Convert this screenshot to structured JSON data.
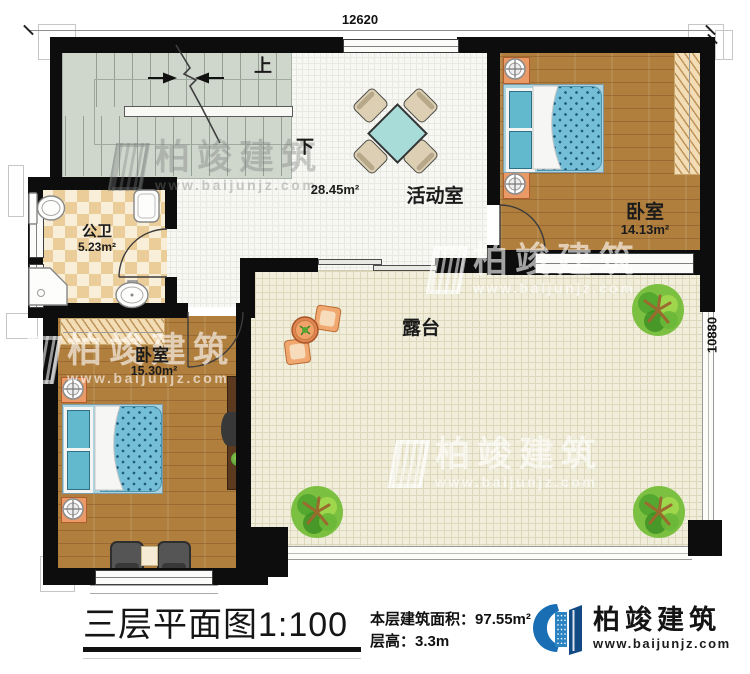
{
  "plan": {
    "dimensions": {
      "top": "12620",
      "right": "10880"
    },
    "stairs": {
      "up": "上",
      "down": "下"
    },
    "rooms": {
      "bathroom": {
        "label": "公卫",
        "area": "5.23m²"
      },
      "activity": {
        "label": "活动室",
        "area": "28.45m²"
      },
      "bedroom_top": {
        "label": "卧室",
        "area": "14.13m²"
      },
      "bedroom_bottom": {
        "label": "卧室",
        "area": "15.30m²"
      },
      "terrace": {
        "label": "露台"
      }
    }
  },
  "titleblock": {
    "title": "三层平面图",
    "scale": "1:100",
    "area_label": "本层建筑面积：",
    "area_value": "97.55m²",
    "height_label": "层高：",
    "height_value": "3.3m"
  },
  "brand": {
    "name": "柏竣建筑",
    "url": "www.baijunjz.com"
  },
  "watermark": {
    "name": "柏竣建筑",
    "url": "www.baijunjz.com"
  }
}
